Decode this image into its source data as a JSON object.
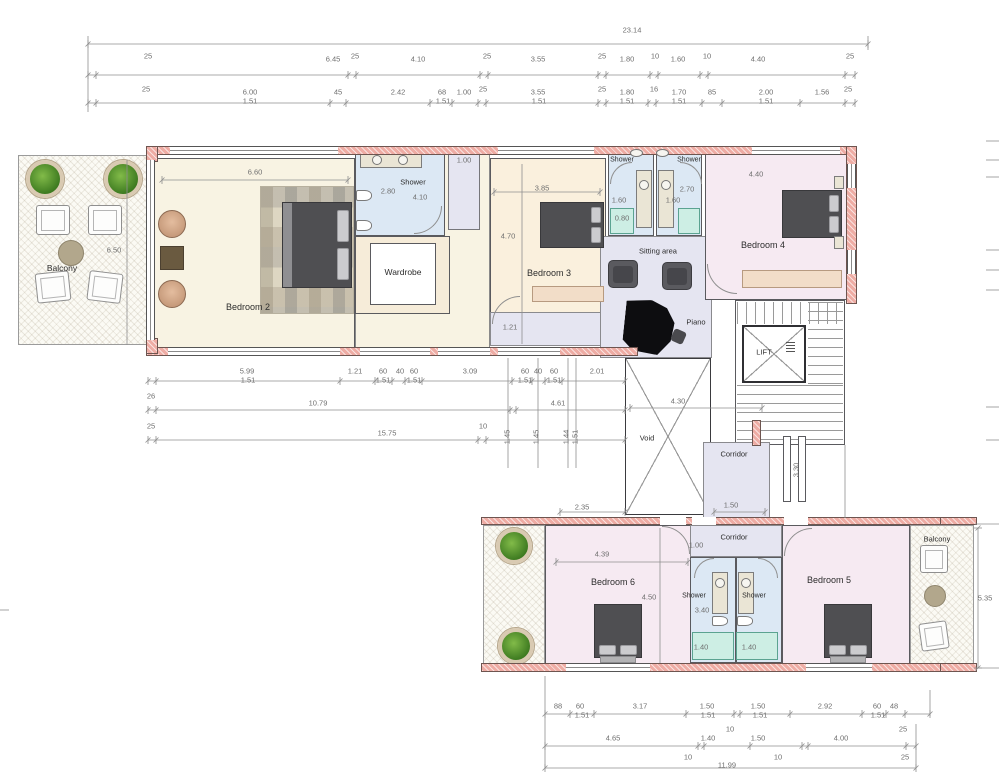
{
  "rooms": {
    "balcony_left": "Balcony",
    "bedroom2": "Bedroom 2",
    "shower2": "Shower",
    "wardrobe": "Wardrobe",
    "bedroom3": "Bedroom 3",
    "shower_c1": "Shower",
    "shower_c2": "Shower",
    "sitting": "Sitting area",
    "piano": "Piano",
    "bedroom4": "Bedroom 4",
    "lift": "LIFT",
    "void_area": "Void",
    "corridor_up": "Corridor",
    "corridor_low": "Corridor",
    "bedroom6": "Bedroom 6",
    "shower_b1": "Shower",
    "shower_b2": "Shower",
    "bedroom5": "Bedroom 5",
    "balcony_right": "Balcony"
  },
  "colors": {
    "wall": "#eeaca4",
    "cream": "#f8f3e3",
    "peach_cream": "#faf0dd",
    "pink_room": "#f6eaf2",
    "shower_blue": "#dce8f4",
    "lavender": "#e5e5f1",
    "teal_tray": "#cdeee4",
    "bench": "#f2ddc8"
  },
  "annotations": [
    {
      "t": "23.14",
      "x": 632,
      "y": 30
    },
    {
      "t": "25",
      "x": 148,
      "y": 56
    },
    {
      "t": "6.45",
      "x": 333,
      "y": 59
    },
    {
      "t": "25",
      "x": 355,
      "y": 56
    },
    {
      "t": "4.10",
      "x": 418,
      "y": 59
    },
    {
      "t": "25",
      "x": 487,
      "y": 56
    },
    {
      "t": "3.55",
      "x": 538,
      "y": 59
    },
    {
      "t": "25",
      "x": 602,
      "y": 56
    },
    {
      "t": "1.80",
      "x": 627,
      "y": 59
    },
    {
      "t": "10",
      "x": 655,
      "y": 56
    },
    {
      "t": "1.60",
      "x": 678,
      "y": 59
    },
    {
      "t": "10",
      "x": 707,
      "y": 56
    },
    {
      "t": "4.40",
      "x": 758,
      "y": 59
    },
    {
      "t": "25",
      "x": 850,
      "y": 56
    },
    {
      "t": "25",
      "x": 146,
      "y": 89
    },
    {
      "t": "6.00",
      "x": 250,
      "y": 92
    },
    {
      "t": "1.51",
      "x": 250,
      "y": 101
    },
    {
      "t": "45",
      "x": 338,
      "y": 92
    },
    {
      "t": "2.42",
      "x": 398,
      "y": 92
    },
    {
      "t": "68",
      "x": 442,
      "y": 92
    },
    {
      "t": "1.51",
      "x": 443,
      "y": 101
    },
    {
      "t": "1.00",
      "x": 464,
      "y": 92
    },
    {
      "t": "25",
      "x": 483,
      "y": 89
    },
    {
      "t": "3.55",
      "x": 538,
      "y": 92
    },
    {
      "t": "1.51",
      "x": 539,
      "y": 101
    },
    {
      "t": "25",
      "x": 602,
      "y": 89
    },
    {
      "t": "1.80",
      "x": 627,
      "y": 92
    },
    {
      "t": "1.51",
      "x": 627,
      "y": 101
    },
    {
      "t": "16",
      "x": 654,
      "y": 89
    },
    {
      "t": "1.70",
      "x": 679,
      "y": 92
    },
    {
      "t": "1.51",
      "x": 679,
      "y": 101
    },
    {
      "t": "85",
      "x": 712,
      "y": 92
    },
    {
      "t": "2.00",
      "x": 766,
      "y": 92
    },
    {
      "t": "1.51",
      "x": 766,
      "y": 101
    },
    {
      "t": "1.56",
      "x": 822,
      "y": 92
    },
    {
      "t": "25",
      "x": 848,
      "y": 89
    },
    {
      "t": "6.60",
      "x": 255,
      "y": 172
    },
    {
      "t": "6.50",
      "x": 114,
      "y": 250
    },
    {
      "t": "2.80",
      "x": 388,
      "y": 191
    },
    {
      "t": "4.10",
      "x": 420,
      "y": 197
    },
    {
      "t": "1.00",
      "x": 464,
      "y": 160
    },
    {
      "t": "3.85",
      "x": 542,
      "y": 188
    },
    {
      "t": "4.70",
      "x": 508,
      "y": 236
    },
    {
      "t": "1.21",
      "x": 510,
      "y": 327
    },
    {
      "t": "1.60",
      "x": 619,
      "y": 200
    },
    {
      "t": "1.60",
      "x": 673,
      "y": 200
    },
    {
      "t": "0.80",
      "x": 622,
      "y": 218
    },
    {
      "t": "2.70",
      "x": 687,
      "y": 189
    },
    {
      "t": "4.40",
      "x": 756,
      "y": 174
    },
    {
      "t": "4.30",
      "x": 678,
      "y": 401
    },
    {
      "t": "1.50",
      "x": 731,
      "y": 505
    },
    {
      "t": "2.35",
      "x": 582,
      "y": 507
    },
    {
      "t": "3.30",
      "x": 796,
      "y": 470,
      "r": -90
    },
    {
      "t": "5.99",
      "x": 247,
      "y": 371
    },
    {
      "t": "1.51",
      "x": 248,
      "y": 380
    },
    {
      "t": "1.21",
      "x": 355,
      "y": 371
    },
    {
      "t": "60",
      "x": 383,
      "y": 371
    },
    {
      "t": "1.51",
      "x": 383,
      "y": 380
    },
    {
      "t": "40",
      "x": 400,
      "y": 371
    },
    {
      "t": "60",
      "x": 414,
      "y": 371
    },
    {
      "t": "1.51",
      "x": 414,
      "y": 380
    },
    {
      "t": "3.09",
      "x": 470,
      "y": 371
    },
    {
      "t": "60",
      "x": 525,
      "y": 371
    },
    {
      "t": "1.51",
      "x": 525,
      "y": 380
    },
    {
      "t": "40",
      "x": 538,
      "y": 371
    },
    {
      "t": "60",
      "x": 554,
      "y": 371
    },
    {
      "t": "1.51",
      "x": 554,
      "y": 380
    },
    {
      "t": "2.01",
      "x": 597,
      "y": 371
    },
    {
      "t": "26",
      "x": 151,
      "y": 396
    },
    {
      "t": "10.79",
      "x": 318,
      "y": 403
    },
    {
      "t": "4.61",
      "x": 558,
      "y": 403
    },
    {
      "t": "25",
      "x": 151,
      "y": 426
    },
    {
      "t": "15.75",
      "x": 387,
      "y": 433
    },
    {
      "t": "10",
      "x": 483,
      "y": 426
    },
    {
      "t": "1.45",
      "x": 507,
      "y": 437,
      "r": -90
    },
    {
      "t": "1.45",
      "x": 536,
      "y": 437,
      "r": -90
    },
    {
      "t": "1.44",
      "x": 566,
      "y": 437,
      "r": -90
    },
    {
      "t": "1.51",
      "x": 575,
      "y": 437,
      "r": -90
    },
    {
      "t": "4.39",
      "x": 602,
      "y": 554
    },
    {
      "t": "4.50",
      "x": 649,
      "y": 597
    },
    {
      "t": "1.00",
      "x": 696,
      "y": 545
    },
    {
      "t": "3.40",
      "x": 702,
      "y": 610
    },
    {
      "t": "1.40",
      "x": 701,
      "y": 647
    },
    {
      "t": "1.40",
      "x": 749,
      "y": 647
    },
    {
      "t": "5.35",
      "x": 985,
      "y": 598
    },
    {
      "t": "88",
      "x": 558,
      "y": 706
    },
    {
      "t": "60",
      "x": 580,
      "y": 706
    },
    {
      "t": "1.51",
      "x": 582,
      "y": 715
    },
    {
      "t": "3.17",
      "x": 640,
      "y": 706
    },
    {
      "t": "1.50",
      "x": 707,
      "y": 706
    },
    {
      "t": "1.51",
      "x": 708,
      "y": 715
    },
    {
      "t": "1.50",
      "x": 758,
      "y": 706
    },
    {
      "t": "1.51",
      "x": 760,
      "y": 715
    },
    {
      "t": "2.92",
      "x": 825,
      "y": 706
    },
    {
      "t": "60",
      "x": 877,
      "y": 706
    },
    {
      "t": "1.51",
      "x": 878,
      "y": 715
    },
    {
      "t": "48",
      "x": 894,
      "y": 706
    },
    {
      "t": "10",
      "x": 730,
      "y": 729
    },
    {
      "t": "25",
      "x": 903,
      "y": 729
    },
    {
      "t": "4.65",
      "x": 613,
      "y": 738
    },
    {
      "t": "1.40",
      "x": 708,
      "y": 738
    },
    {
      "t": "1.50",
      "x": 758,
      "y": 738
    },
    {
      "t": "4.00",
      "x": 841,
      "y": 738
    },
    {
      "t": "10",
      "x": 688,
      "y": 757
    },
    {
      "t": "10",
      "x": 778,
      "y": 757
    },
    {
      "t": "25",
      "x": 905,
      "y": 757
    },
    {
      "t": "11.99",
      "x": 727,
      "y": 765
    }
  ],
  "dimlines": {
    "h": [
      {
        "y": 44,
        "x1": 88,
        "x2": 868,
        "ticks": [
          88,
          868
        ]
      },
      {
        "y": 75,
        "x1": 88,
        "x2": 855,
        "ticks": [
          88,
          96,
          348,
          356,
          480,
          488,
          598,
          606,
          650,
          658,
          700,
          708,
          845,
          855
        ]
      },
      {
        "y": 103,
        "x1": 88,
        "x2": 855,
        "ticks": [
          88,
          96,
          330,
          346,
          430,
          452,
          478,
          486,
          598,
          606,
          648,
          656,
          702,
          722,
          800,
          845,
          855
        ]
      },
      {
        "y": 180,
        "x1": 162,
        "x2": 348,
        "ticks": [
          162,
          348
        ]
      },
      {
        "y": 192,
        "x1": 494,
        "x2": 600,
        "ticks": [
          494,
          600
        ]
      },
      {
        "y": 381,
        "x1": 148,
        "x2": 625,
        "ticks": [
          148,
          156,
          340,
          375,
          392,
          405,
          422,
          512,
          532,
          545,
          562,
          625
        ]
      },
      {
        "y": 410,
        "x1": 148,
        "x2": 625,
        "ticks": [
          148,
          156,
          510,
          516,
          625
        ]
      },
      {
        "y": 440,
        "x1": 148,
        "x2": 625,
        "ticks": [
          148,
          156,
          478,
          486,
          625
        ]
      },
      {
        "y": 408,
        "x1": 630,
        "x2": 762,
        "ticks": [
          630,
          762
        ]
      },
      {
        "y": 512,
        "x1": 560,
        "x2": 625,
        "ticks": [
          560,
          625
        ]
      },
      {
        "y": 512,
        "x1": 714,
        "x2": 765,
        "ticks": [
          714,
          765
        ]
      },
      {
        "y": 562,
        "x1": 556,
        "x2": 688,
        "ticks": [
          556,
          688
        ]
      },
      {
        "y": 714,
        "x1": 545,
        "x2": 930,
        "ticks": [
          545,
          570,
          594,
          686,
          734,
          740,
          790,
          862,
          886,
          905,
          930
        ]
      },
      {
        "y": 746,
        "x1": 545,
        "x2": 916,
        "ticks": [
          545,
          698,
          704,
          750,
          802,
          808,
          906,
          916
        ]
      },
      {
        "y": 768,
        "x1": 545,
        "x2": 916,
        "ticks": [
          545,
          916
        ]
      },
      {
        "y": 524,
        "x1": 975,
        "x2": 999
      },
      {
        "y": 668,
        "x1": 975,
        "x2": 999
      }
    ],
    "v": [
      {
        "x": 88,
        "y1": 36,
        "y2": 112
      },
      {
        "x": 868,
        "y1": 36,
        "y2": 50
      },
      {
        "x": 127,
        "y1": 160,
        "y2": 345
      },
      {
        "x": 522,
        "y1": 164,
        "y2": 344
      },
      {
        "x": 660,
        "y1": 528,
        "y2": 663
      },
      {
        "x": 978,
        "y1": 528,
        "y2": 668,
        "ticks": [
          528,
          668
        ]
      },
      {
        "x": 508,
        "y1": 358,
        "y2": 468
      },
      {
        "x": 538,
        "y1": 358,
        "y2": 468
      },
      {
        "x": 568,
        "y1": 358,
        "y2": 468
      },
      {
        "x": 576,
        "y1": 358,
        "y2": 468
      },
      {
        "x": 845,
        "y1": 445,
        "y2": 518
      },
      {
        "x": 545,
        "y1": 676,
        "y2": 768
      },
      {
        "x": 916,
        "y1": 724,
        "y2": 768
      },
      {
        "x": 930,
        "y1": 690,
        "y2": 716
      }
    ],
    "edge_right": [
      141,
      160,
      177,
      250,
      270,
      290,
      407,
      440
    ],
    "edge_left": [
      610
    ]
  }
}
